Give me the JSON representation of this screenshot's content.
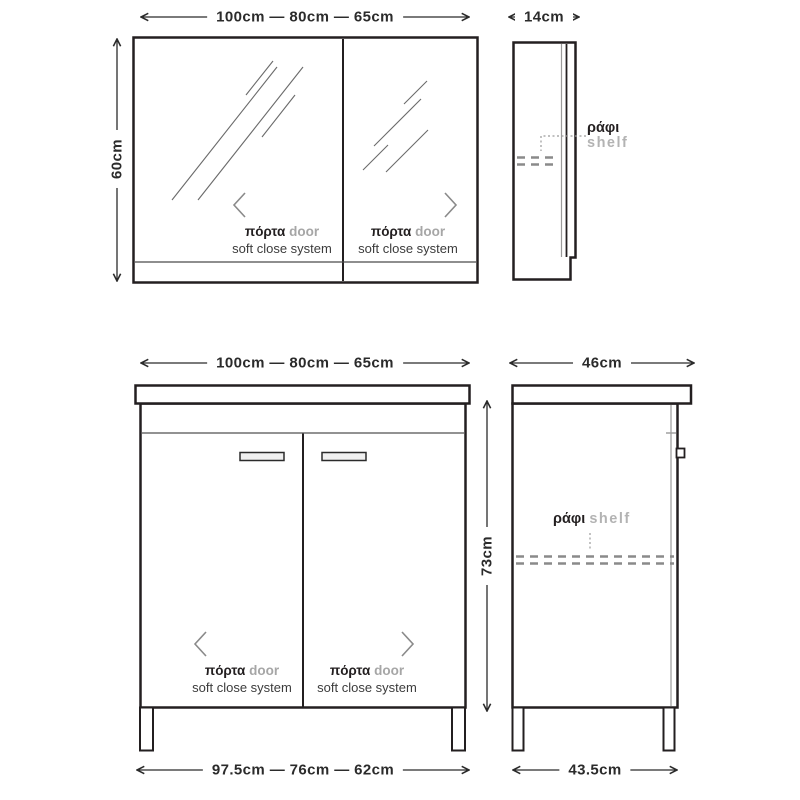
{
  "palette": {
    "outline": "#231f20",
    "detail_gray": "#8f8f8f",
    "text_gray": "#a6a6a6",
    "background": "#ffffff"
  },
  "mirror_front": {
    "width_dim": "100cm — 80cm — 65cm",
    "height_dim": "60cm",
    "doors": [
      {
        "label_el": "πόρτα",
        "label_en": "door",
        "subtitle": "soft close system"
      },
      {
        "label_el": "πόρτα",
        "label_en": "door",
        "subtitle": "soft close system"
      }
    ]
  },
  "mirror_side": {
    "depth_dim": "14cm",
    "shelf_label_el": "ράφι",
    "shelf_label_en": "shelf"
  },
  "vanity_front": {
    "width_dim": "100cm — 80cm — 65cm",
    "height_dim": "73cm",
    "base_width_dim": "97.5cm — 76cm — 62cm",
    "doors": [
      {
        "label_el": "πόρτα",
        "label_en": "door",
        "subtitle": "soft close system"
      },
      {
        "label_el": "πόρτα",
        "label_en": "door",
        "subtitle": "soft close system"
      }
    ]
  },
  "vanity_side": {
    "depth_dim": "46cm",
    "base_depth_dim": "43.5cm",
    "shelf_label_el": "ράφι",
    "shelf_label_en": "shelf"
  }
}
